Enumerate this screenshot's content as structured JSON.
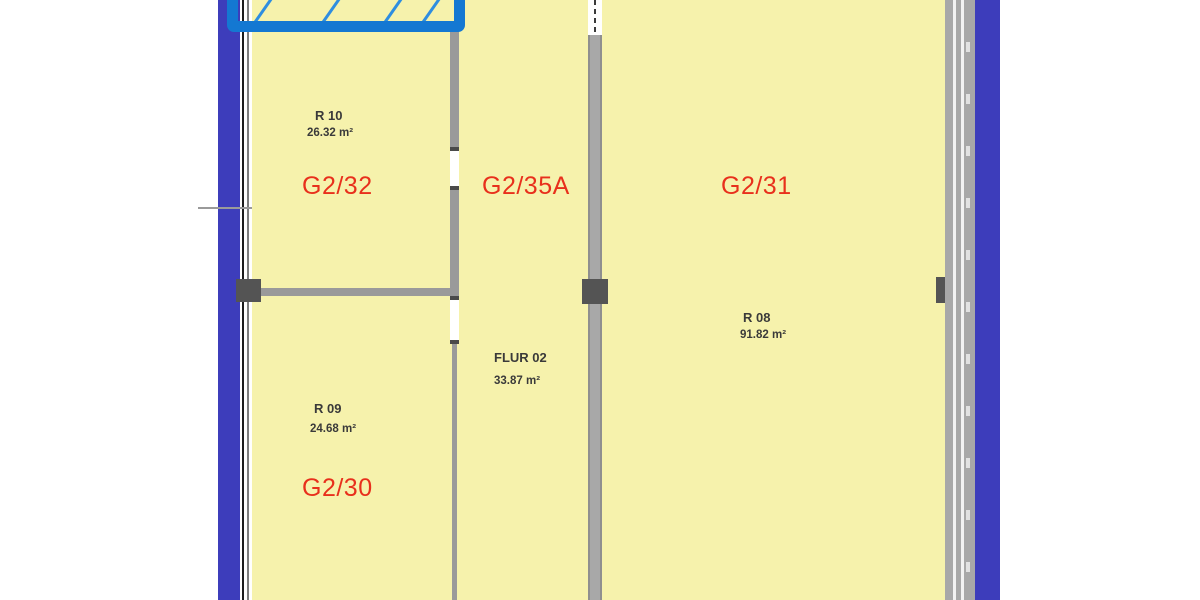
{
  "plan": {
    "type": "floorplan",
    "rooms": [
      {
        "code": "G2/32",
        "number": "R 10",
        "area": "26.32 m²"
      },
      {
        "code": "G2/30",
        "number": "R 09",
        "area": "24.68 m²"
      },
      {
        "code": "G2/35A",
        "number": "FLUR 02",
        "area": "33.87 m²"
      },
      {
        "code": "G2/31",
        "number": "R 08",
        "area": "91.82 m²"
      }
    ],
    "selection": {
      "selected_room": "G2/33 (partially visible, highlighted)"
    }
  },
  "colors": {
    "room_fill": "#f6f2ac",
    "exterior_band": "#3d3dbb",
    "wall_gray": "#9a9a9a",
    "corridor_wall": "#a8a8a8",
    "connector": "#545454",
    "selection_blue": "#1478d2",
    "hatch_blue": "#2e8ee0",
    "room_code_red": "#e8301c",
    "text_dark": "#3a3a3a"
  }
}
